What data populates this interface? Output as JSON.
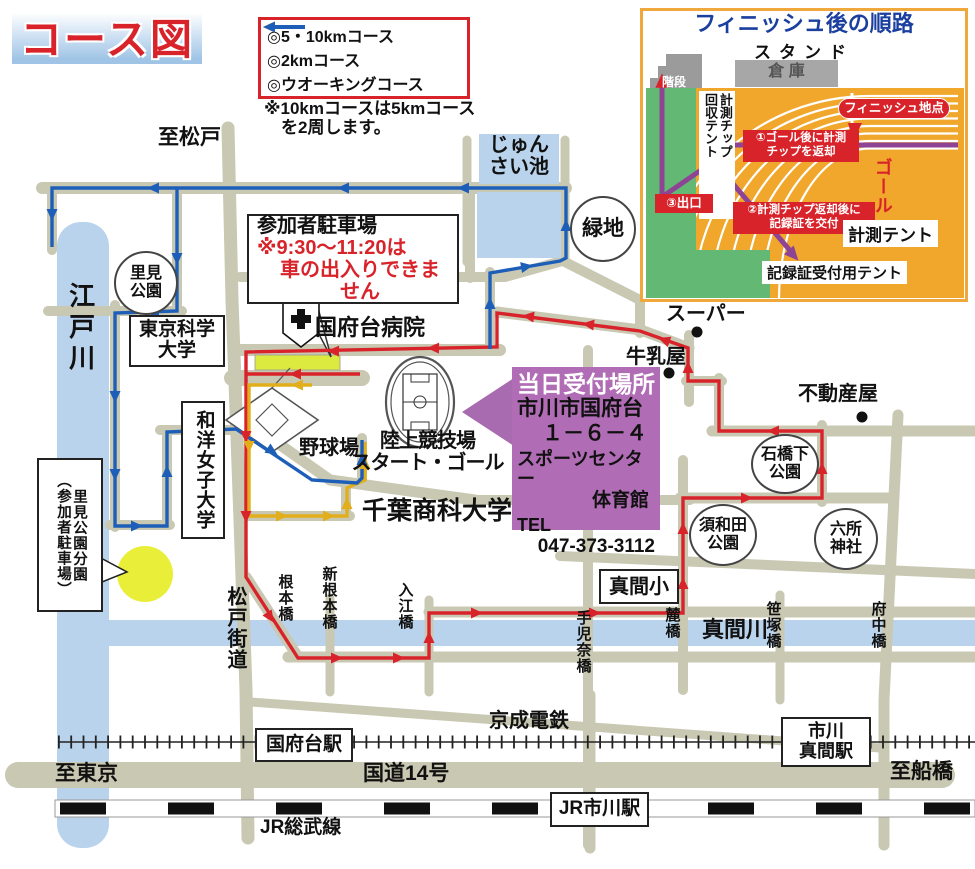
{
  "title": "コース図",
  "legend": {
    "items": [
      {
        "label": "◎5・10kmコース",
        "color": "#d8232a"
      },
      {
        "label": "◎2kmコース",
        "color": "#e2ae1b"
      },
      {
        "label": "◎ウオーキングコース",
        "color": "#1d5fb8"
      }
    ],
    "note": "※10kmコースは5kmコース\n　を2周します。"
  },
  "inset": {
    "title": "フィニッシュ後の順路",
    "stand": "スタンド",
    "stairs": "階段",
    "warehouse": "倉 庫",
    "tent_collect": "計測チップ\n回収テント",
    "finish_point": "フィニッシュ地点",
    "step1": "①ゴール後に計測\nチップを返却",
    "step2": "②計測チップ返却後に\n記録証を交付",
    "step3": "③出口",
    "goal": "ゴール",
    "tent_measure": "計測テント",
    "tent_cert": "記録証受付用テント"
  },
  "reception": {
    "title": "当日受付場所",
    "addr1": "市川市国府台",
    "addr2": "１－６－４",
    "addr3": "スポーツセンター",
    "addr4": "体育館",
    "tel_label": "TEL",
    "tel": "047-373-3112"
  },
  "parking_note": {
    "line1": "参加者駐車場",
    "line2": "※9:30～11:20は",
    "line3": "車の出入りできません"
  },
  "map": {
    "to_matsudo": "至松戸",
    "pond": "じゅん\nさい池",
    "green_space": "緑地",
    "satomi_park": "里見\n公園",
    "univ_science": "東京科学\n大学",
    "univ_wayo": "和洋女子大学",
    "edogawa": "江戸川",
    "hospital": "国府台病院",
    "ballpark": "野球場",
    "stadium": "陸上競技場\nスタート・ゴール",
    "chiba_univ": "千葉商科大学",
    "satomi_branch": "里見公園分園\n（参加者駐車場）",
    "super": "スーパー",
    "milk": "牛乳屋",
    "realtor": "不動産屋",
    "ishibashi_park": "石橋下\n公園",
    "suwada_park": "須和田\n公園",
    "rokusho_shrine": "六所\n神社",
    "mama_elementary": "真間小",
    "mama_river": "真間川",
    "matsudo_road": "松戸街道",
    "bridge_nemoto": "根本橋",
    "bridge_shin_nemoto": "新根本橋",
    "bridge_irie": "入江橋",
    "bridge_tekona": "手児奈橋",
    "bridge_fumoto": "麓橋",
    "bridge_sasazuka": "笹塚橋",
    "bridge_fuchu": "府中橋"
  },
  "rail": {
    "keisei": "京成電鉄",
    "konodai_station": "国府台駅",
    "ichikawamama_station": "市川\n真間駅",
    "jr_sobu": "JR総武線",
    "jr_ichikawa_station": "JR市川駅",
    "route14": "国道14号",
    "to_tokyo": "至東京",
    "to_funabashi": "至船橋"
  },
  "colors": {
    "course_red": "#d8232a",
    "course_yellow": "#e2ae1b",
    "course_blue": "#1d5fb8",
    "arrow_purple": "#8e4394",
    "road": "#c9c8b2",
    "river": "#b9d3ec",
    "track_orange": "#f0a72b",
    "infield_green": "#63b874",
    "reception_purple": "#b06cb4",
    "parking_yellow": "#e9ef39"
  }
}
